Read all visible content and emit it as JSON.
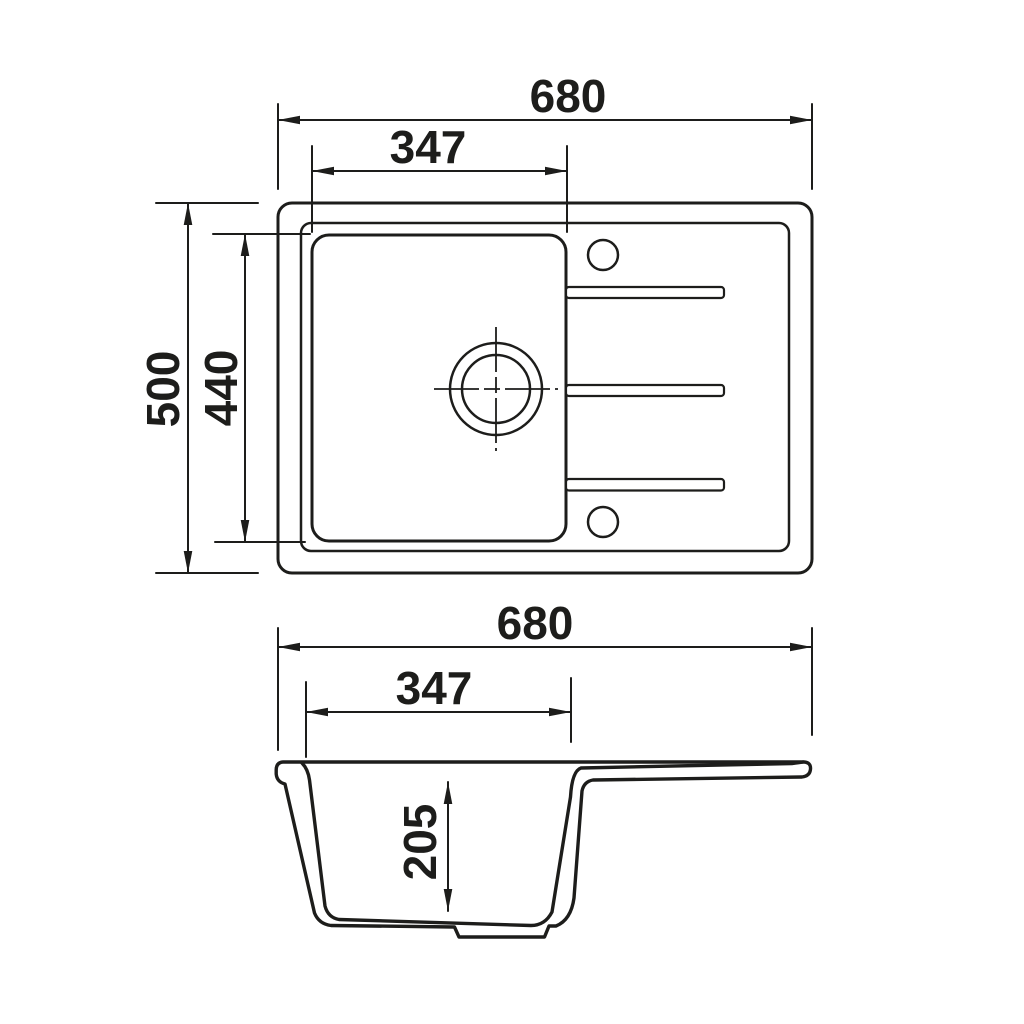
{
  "diagram": {
    "type": "technical-drawing",
    "subject": "kitchen sink with single bowl and drainboard, top view and section view",
    "colors": {
      "background": "#ffffff",
      "line": "#1d1d1b"
    },
    "top_view": {
      "overall_width_mm": "680",
      "bowl_width_mm": "347",
      "overall_depth_mm": "500",
      "bowl_depth_mm": "440",
      "groove_count": 3,
      "hole_count": 2
    },
    "section_view": {
      "overall_width_mm": "680",
      "bowl_width_mm": "347",
      "bowl_depth_mm": "205"
    }
  }
}
